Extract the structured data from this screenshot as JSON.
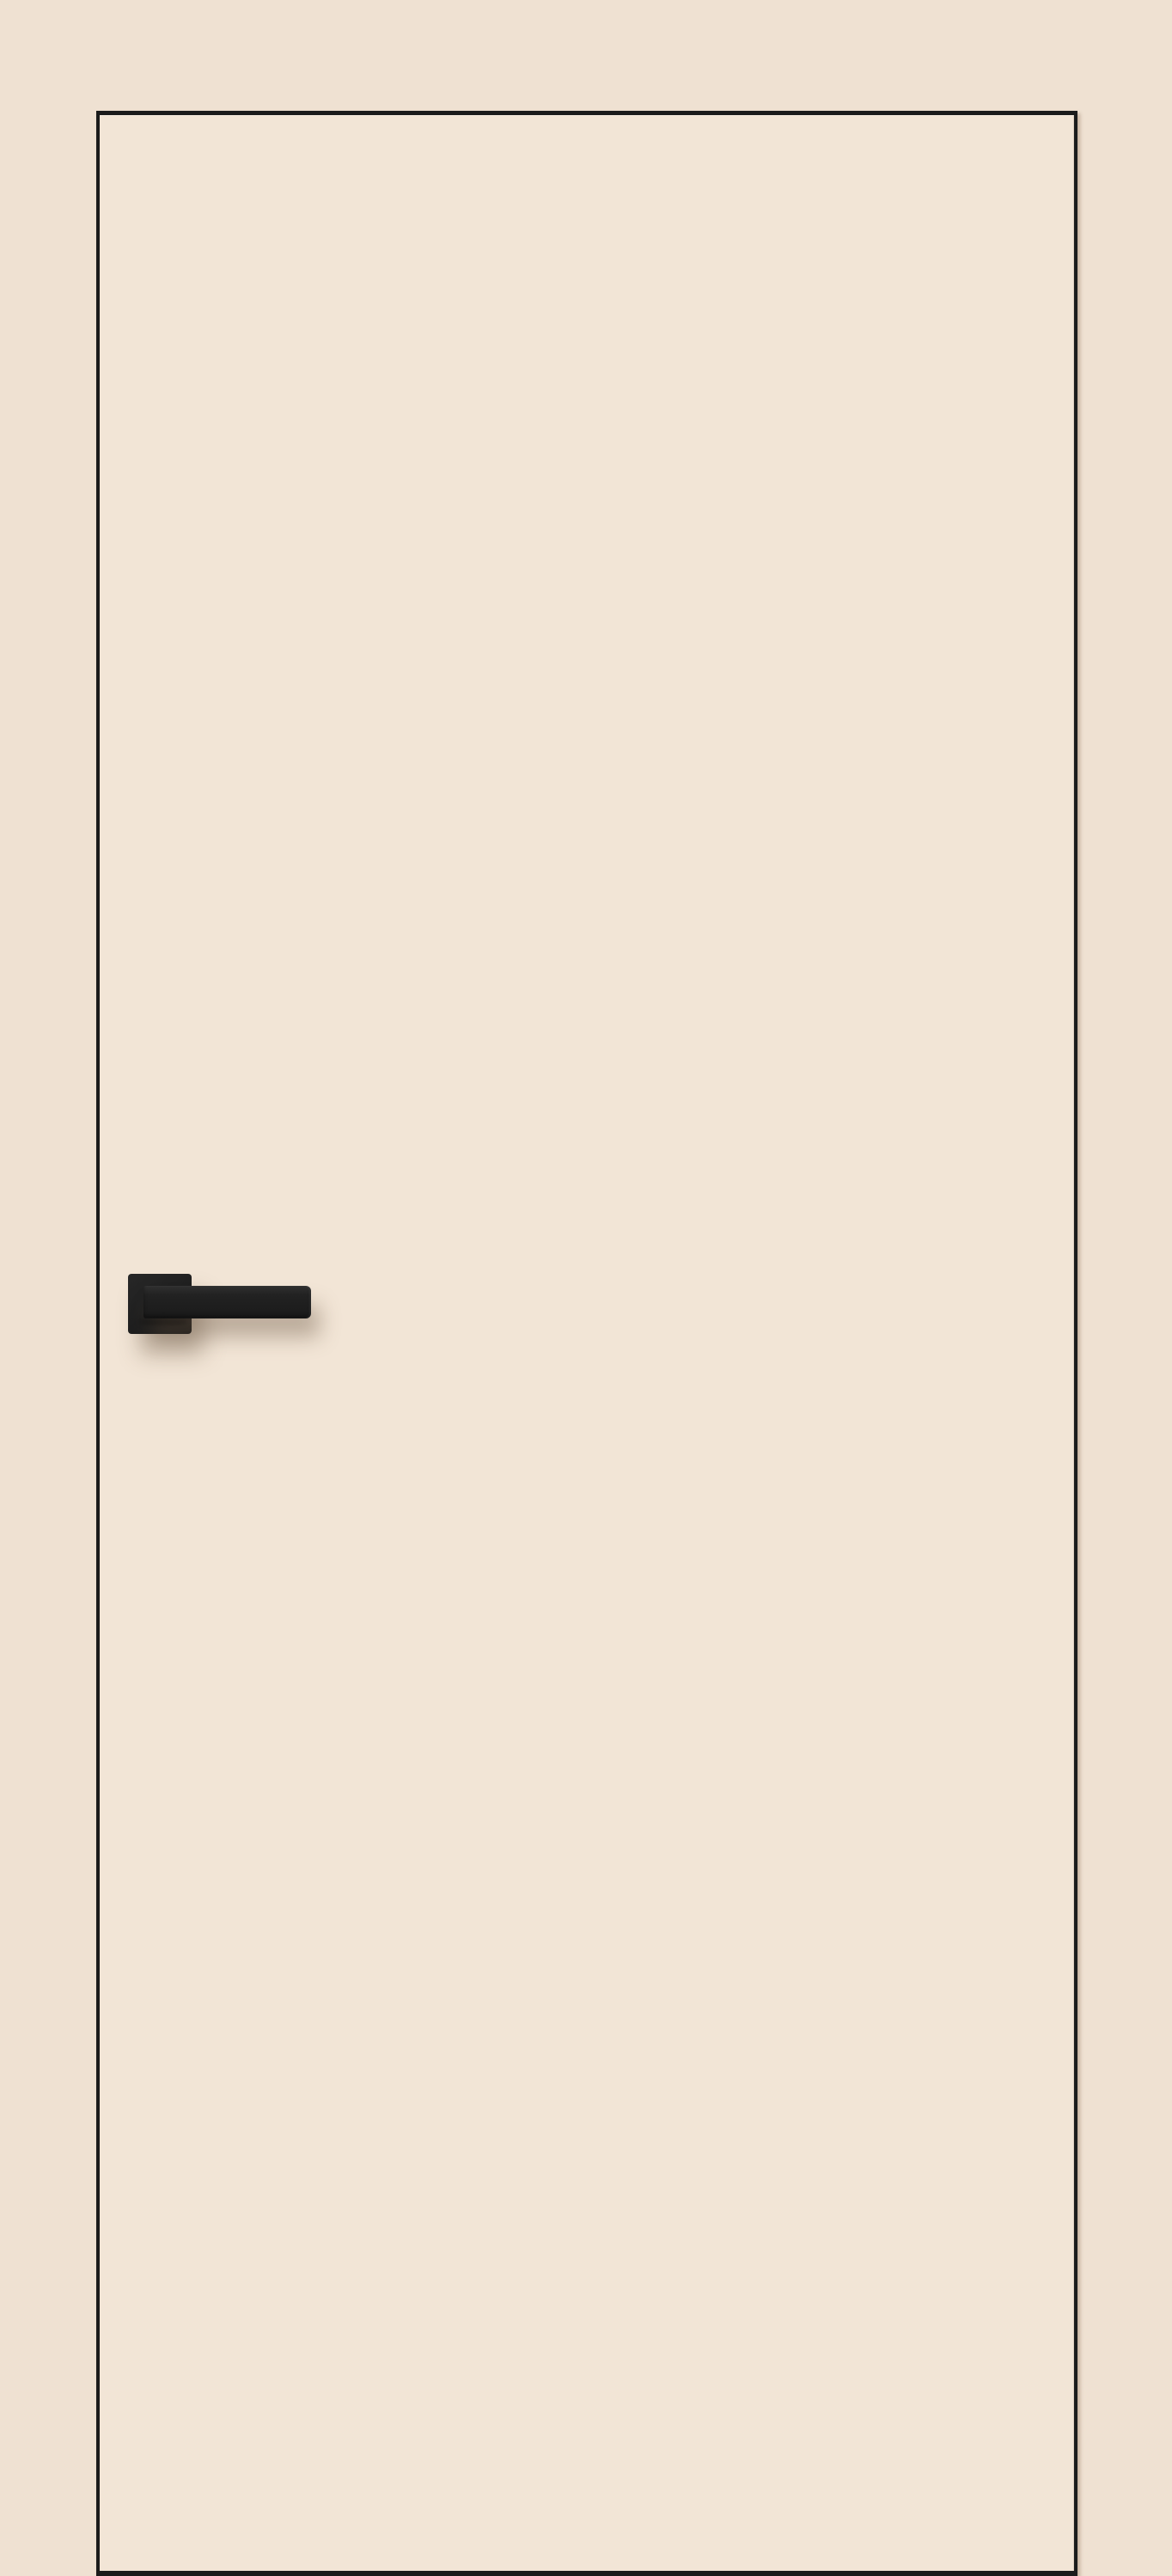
{
  "image": {
    "kind": "product-photo",
    "subject": "cream interior door leaf with black edge trim and black square-rosette lever handle",
    "objects": {
      "door_leaf": "door-leaf",
      "handle_rosette": "handle-rosette-plate",
      "handle_lever": "handle-lever"
    },
    "colors": {
      "background": "#efe1d2",
      "door_face": "#f2e5d6",
      "door_edge": "#1b1b1b",
      "handle": "#1f1f1f",
      "handle_highlight": "#303030",
      "shadow": "rgba(104,84,66,0.40)"
    }
  }
}
